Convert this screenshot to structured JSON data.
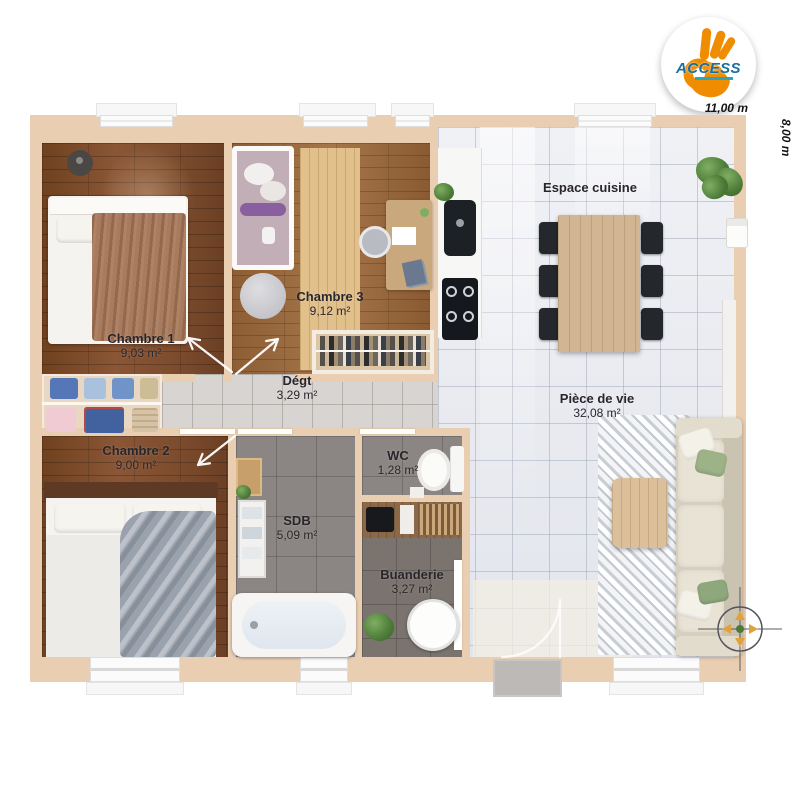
{
  "logo": {
    "brand": "ACCESS"
  },
  "dimensions": {
    "width": "11,00 m",
    "height": "8,00 m"
  },
  "rooms": {
    "chambre1": {
      "name": "Chambre 1",
      "area": "9,03 m²"
    },
    "chambre2": {
      "name": "Chambre 2",
      "area": "9,00 m²"
    },
    "chambre3": {
      "name": "Chambre 3",
      "area": "9,12 m²"
    },
    "degagement": {
      "name": "Dégt",
      "area": "3,29 m²"
    },
    "sdb": {
      "name": "SDB",
      "area": "5,09 m²"
    },
    "wc": {
      "name": "WC",
      "area": "1,28 m²"
    },
    "buanderie": {
      "name": "Buanderie",
      "area": "3,27 m²"
    },
    "cuisine": {
      "name": "Espace cuisine"
    },
    "piece_de_vie": {
      "name": "Pièce de vie",
      "area": "32,08 m²"
    }
  },
  "colors": {
    "wall": "#e9ceb2",
    "wood_dark": "#7c4b2d",
    "wood_light": "#98683e",
    "tile_light": "#e9ebf0",
    "tile_dark": "#8b8683",
    "logo_orange": "#f08c00",
    "logo_blue": "#1a6f9e"
  }
}
